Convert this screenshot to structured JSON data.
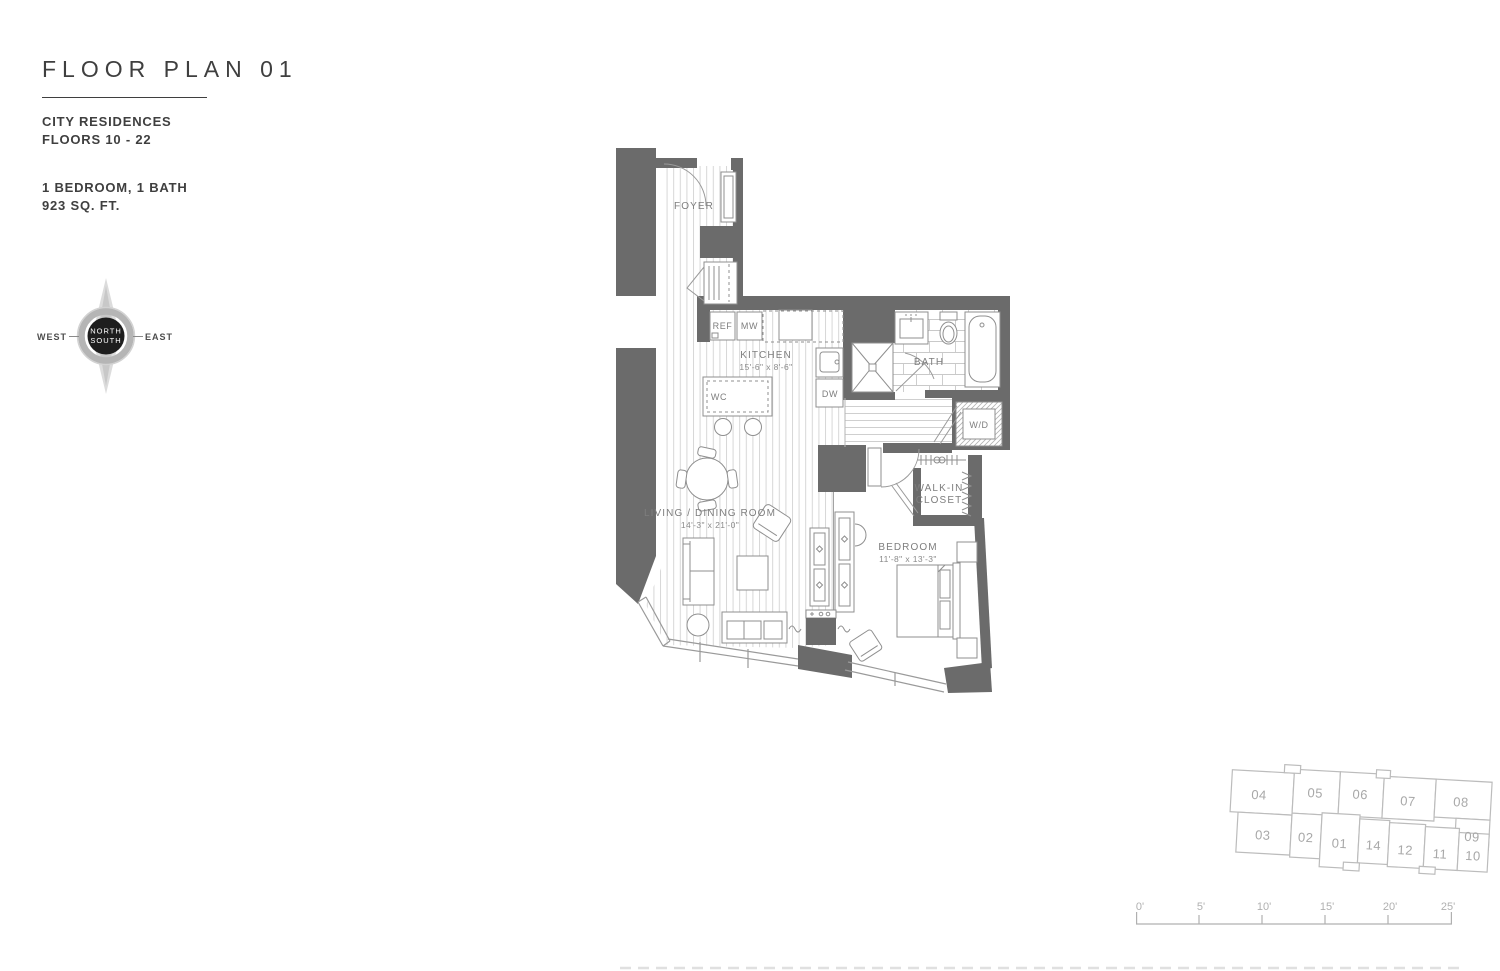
{
  "title_block": {
    "title": "FLOOR PLAN 01",
    "building": "CITY RESIDENCES",
    "floors": "FLOORS 10 - 22",
    "config": "1 BEDROOM, 1 BATH",
    "area": "923 SQ. FT."
  },
  "compass": {
    "north": "NORTH",
    "south": "SOUTH",
    "west": "WEST",
    "east": "EAST"
  },
  "plan": {
    "foyer": "FOYER",
    "kitchen": "KITCHEN",
    "kitchen_dim": "15'-6\" x 8'-6\"",
    "living": "LIVING / DINING ROOM",
    "living_dim": "14'-3\" x 21'-0\"",
    "bedroom": "BEDROOM",
    "bedroom_dim": "11'-8\" x 13'-3\"",
    "bath": "BATH",
    "wic1": "WALK-IN",
    "wic2": "CLOSET",
    "ref": "REF",
    "mw": "MW",
    "wc": "WC",
    "dw": "DW",
    "wd": "W/D"
  },
  "keyplan": {
    "highlighted_unit": "01",
    "units": [
      {
        "id": "04"
      },
      {
        "id": "05"
      },
      {
        "id": "06"
      },
      {
        "id": "07"
      },
      {
        "id": "08"
      },
      {
        "id": "09"
      },
      {
        "id": "03"
      },
      {
        "id": "02"
      },
      {
        "id": "01",
        "highlighted": true
      },
      {
        "id": "14"
      },
      {
        "id": "12"
      },
      {
        "id": "11"
      },
      {
        "id": "10"
      }
    ]
  },
  "scale": {
    "ticks": [
      {
        "label": "0'"
      },
      {
        "label": "5'"
      },
      {
        "label": "10'"
      },
      {
        "label": "15'"
      },
      {
        "label": "20'"
      },
      {
        "label": "25'"
      }
    ]
  },
  "colors": {
    "wall": "#6b6b6b",
    "fixture_line": "#8f8f8f",
    "floor_line": "#d6d6d6",
    "label_text": "#7e7e7e",
    "title_text": "#3f3f3f",
    "keyplan_line": "#bcbcbc",
    "keyplan_text": "#a8a8a8",
    "keyplan_highlight_fill": "#bdbdbd",
    "keyplan_highlight_text": "#ededed",
    "compass_center": "#1e1e1e",
    "scale_line": "#b0b0b0"
  }
}
